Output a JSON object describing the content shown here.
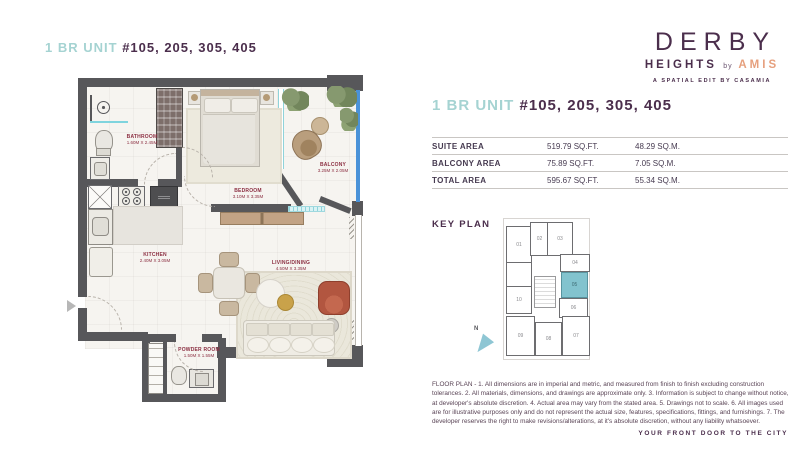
{
  "unit_title": {
    "prefix": "1 BR UNIT",
    "numbers": "#105, 205, 305, 405"
  },
  "logo": {
    "name": "DERBY",
    "sub": "HEIGHTS",
    "by": "by",
    "brand": "AMIS",
    "tagline": "A SPATIAL EDIT BY CASAMIA"
  },
  "area_table": {
    "rows": [
      {
        "label": "SUITE AREA",
        "sqft": "519.79 SQ.FT.",
        "sqm": "48.29 SQ.M."
      },
      {
        "label": "BALCONY AREA",
        "sqft": "75.89 SQ.FT.",
        "sqm": "7.05 SQ.M."
      },
      {
        "label": "TOTAL AREA",
        "sqft": "595.67 SQ.FT.",
        "sqm": "55.34 SQ.M."
      }
    ]
  },
  "key_plan": {
    "heading": "KEY PLAN",
    "north_label": "N",
    "highlighted_unit": "05",
    "units": [
      "01",
      "02",
      "03",
      "04",
      "05",
      "06",
      "07",
      "08",
      "09",
      "10"
    ]
  },
  "floor_plan": {
    "rooms": [
      {
        "name": "BATHROOM",
        "dims": "1.60M X 2.45M"
      },
      {
        "name": "BEDROOM",
        "dims": "3.10M X 3.35M"
      },
      {
        "name": "BALCONY",
        "dims": "3.25M X 2.05M"
      },
      {
        "name": "KITCHEN",
        "dims": "2.40M X 3.05M"
      },
      {
        "name": "LIVING/DINING",
        "dims": "4.50M X 3.35M"
      },
      {
        "name": "POWDER ROOM",
        "dims": "1.50M X 1.55M"
      }
    ]
  },
  "disclaimer": "FLOOR PLAN - 1. All dimensions are in imperial and metric, and measured from finish to finish excluding construction tolerances. 2. All materials, dimensions, and drawings are approximate only. 3. Information is subject to change without notice, at developer's absolute discretion. 4. Actual area may vary from the stated area. 5. Drawings not to scale. 6. All images used are for illustrative purposes only and do not represent the actual size, features, specifications, fittings, and furnishings. 7. The developer reserves the right to make revisions/alterations, at it's absolute discretion, without any liability whatsoever.",
  "footer": "YOUR FRONT DOOR TO THE CITY",
  "colors": {
    "plum": "#4b2e4c",
    "teal_text": "#a5d3d2",
    "coral": "#e6a07e",
    "wall": "#57575a",
    "unit_highlight": "#82c3ce",
    "glass_blue": "#4a92d8",
    "room_label": "#8c2f42"
  }
}
